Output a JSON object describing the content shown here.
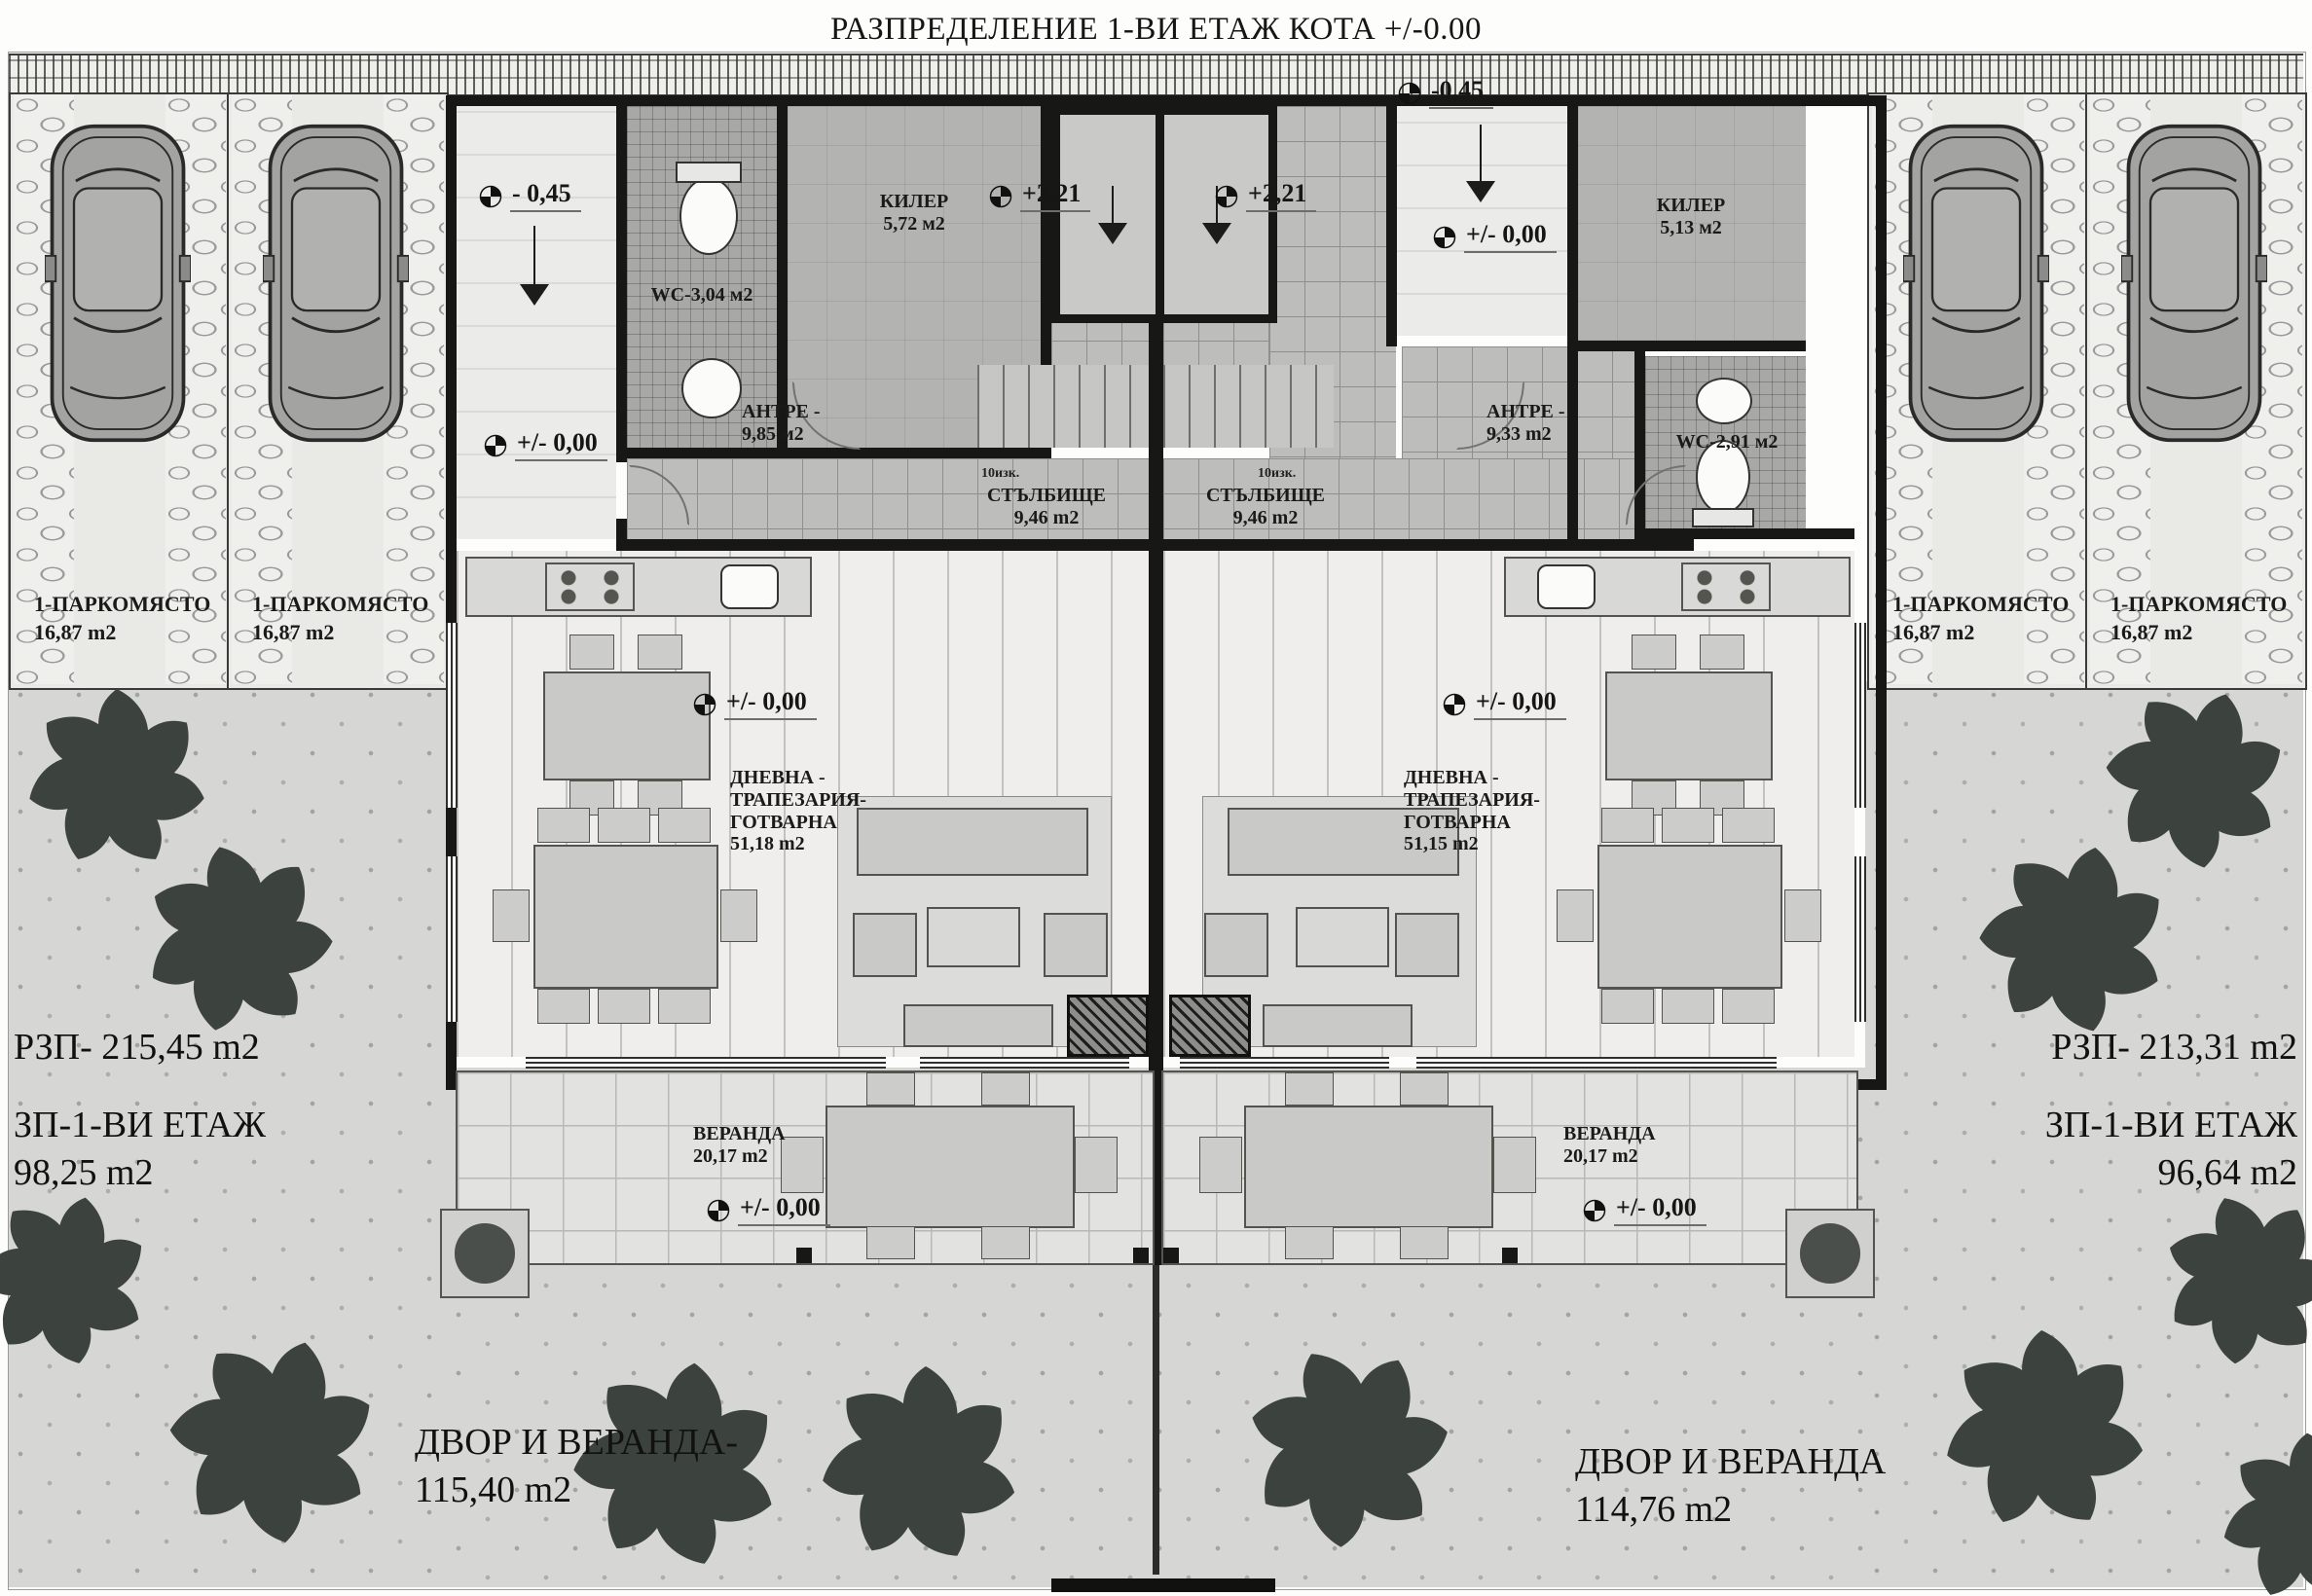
{
  "title": "РАЗПРЕДЕЛЕНИЕ 1-ВИ ЕТАЖ КОТА +/-0.00",
  "parking": {
    "label": "1-ПАРКОМЯСТО",
    "area": "16,87 m2"
  },
  "units": {
    "left": {
      "wc": "WC-3,04 м2",
      "storage_name": "КИЛЕР",
      "storage_area": "5,72 м2",
      "hall_name": "АНТРЕ -",
      "hall_area": "9,85 м2",
      "stairs_name": "СТЪЛБИЩЕ",
      "stairs_area": "9,46 m2",
      "stairs_steps": "10изк.",
      "living_l1": "ДНЕВНА -",
      "living_l2": "ТРАПЕЗАРИЯ-",
      "living_l3": "ГОТВАРНА",
      "living_area": "51,18 m2",
      "veranda_name": "ВЕРАНДА",
      "veranda_area": "20,17 m2"
    },
    "right": {
      "wc": "WC-2,91 м2",
      "storage_name": "КИЛЕР",
      "storage_area": "5,13 м2",
      "hall_name": "АНТРЕ -",
      "hall_area": "9,33 m2",
      "stairs_name": "СТЪЛБИЩЕ",
      "stairs_area": "9,46 m2",
      "stairs_steps": "10изк.",
      "living_l1": "ДНЕВНА -",
      "living_l2": "ТРАПЕЗАРИЯ-",
      "living_l3": "ГОТВАРНА",
      "living_area": "51,15 m2",
      "veranda_name": "ВЕРАНДА",
      "veranda_area": "20,17 m2"
    }
  },
  "levels": {
    "minus045": "- 0,45",
    "minus045_walk": "-0,45",
    "zero": "+/- 0,00",
    "plus221": "+2,21"
  },
  "stats": {
    "left": {
      "rzp": "РЗП- 215,45 m2",
      "zp_label": "ЗП-1-ВИ ЕТАЖ",
      "zp_area": "98,25 m2",
      "yard_label": "ДВОР И ВЕРАНДА-",
      "yard_area": "115,40 m2"
    },
    "right": {
      "rzp": "РЗП-  213,31 m2",
      "zp_label": "ЗП-1-ВИ ЕТАЖ",
      "zp_area": "96,64 m2",
      "yard_label": "ДВОР И ВЕРАНДА",
      "yard_area": "114,76 m2"
    }
  },
  "colors": {
    "wall": "#171715",
    "tree": "#3c423e",
    "paper": "#fdfdfc"
  }
}
